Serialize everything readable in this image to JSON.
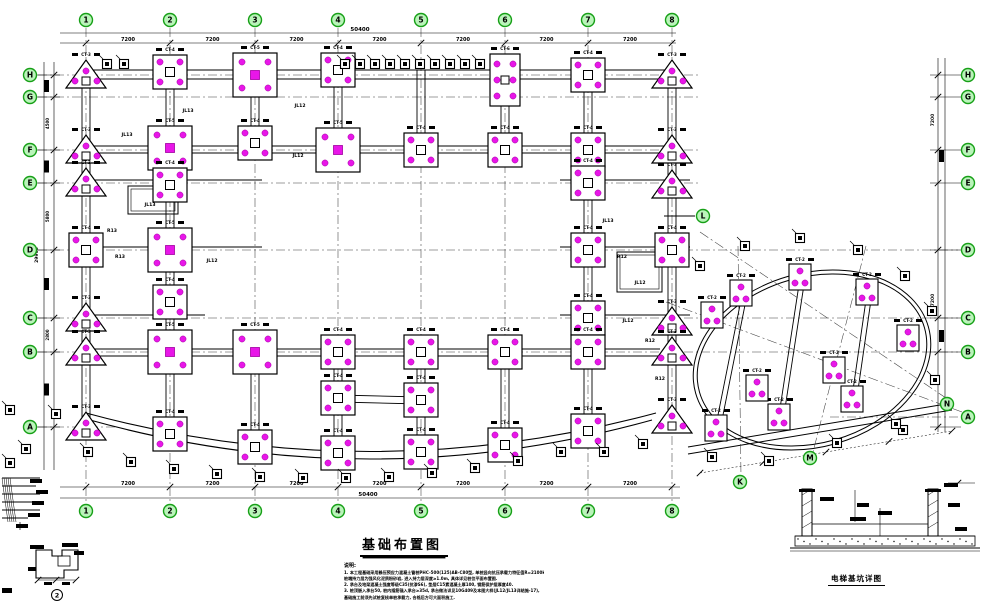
{
  "title_block": {
    "title": "基础布置图",
    "notes_heading": "说明:",
    "notes": [
      "1. 本工程基础采用静压预应力混凝土管桩PHC-500(125)AB-C80型, 单桩竖向抗压承载力特征值R=2100kN,",
      "   桩端持力层为强风化泥质粉砂岩, 进入持力层深度≥1.0m, 具体详见桩位平面布置图.",
      "2. 承台及地梁混凝土强度等级C35(抗渗S6), 垫层C15素混凝土厚100, 钢筋保护层厚度40.",
      "3. 桩顶嵌入承台50, 桩内插筋锚入承台≥35d, 承台做法详见10G409及本图大样(JL12/JL13详结施-17),",
      "   基础施工前须先试桩复核单桩承载力, 合格后方可大面积施工."
    ],
    "section_caption": "电梯基坑详图",
    "detail_bubble": "2"
  },
  "colors": {
    "pile": "#e816e8",
    "pile_edge": "#a000a0",
    "bubble_fill": "#baf4ba",
    "bubble_stroke": "#17a017",
    "bubble_text": "#0a5a0a",
    "line": "#000000",
    "grid": "#3c3c3c"
  },
  "axes": {
    "cols": [
      {
        "l": "1",
        "x": 86
      },
      {
        "l": "2",
        "x": 170
      },
      {
        "l": "3",
        "x": 255
      },
      {
        "l": "4",
        "x": 338
      },
      {
        "l": "5",
        "x": 421
      },
      {
        "l": "6",
        "x": 505
      },
      {
        "l": "7",
        "x": 588
      },
      {
        "l": "8",
        "x": 672
      }
    ],
    "rows": [
      {
        "l": "H",
        "y": 75,
        "x2": 700
      },
      {
        "l": "G",
        "y": 97,
        "x2": 700
      },
      {
        "l": "F",
        "y": 150,
        "x2": 700
      },
      {
        "l": "E",
        "y": 183,
        "x2": 700
      },
      {
        "l": "D",
        "y": 250,
        "x2": 958
      },
      {
        "l": "C",
        "y": 318,
        "x2": 958
      },
      {
        "l": "B",
        "y": 352,
        "x2": 958
      },
      {
        "l": "A",
        "y": 427,
        "x2": 118
      }
    ],
    "right_row_A_y": 417,
    "aux_bubbles": [
      {
        "l": "L",
        "x": 703,
        "y": 216
      },
      {
        "l": "K",
        "x": 740,
        "y": 482
      },
      {
        "l": "M",
        "x": 810,
        "y": 458
      },
      {
        "l": "N",
        "x": 947,
        "y": 404
      }
    ],
    "dims": {
      "seg": "7200",
      "top_total": "50400",
      "left_segs": [
        "1800",
        "4500",
        "2800",
        "5800",
        "5700",
        "2800",
        "6500"
      ],
      "left_total": "29900"
    }
  },
  "cap_tags": {
    "tri3": "CT-3",
    "sq4": "CT-4",
    "sq5": "CT-5",
    "sq6": "CT-6",
    "sq2w": "CT-2"
  },
  "caps": [
    [
      "tri3",
      86,
      75
    ],
    [
      "tri3",
      86,
      150
    ],
    [
      "tri3",
      86,
      183
    ],
    [
      "sq4",
      86,
      250
    ],
    [
      "tri3",
      86,
      318
    ],
    [
      "tri3",
      86,
      352
    ],
    [
      "tri3",
      86,
      427
    ],
    [
      "sq4",
      170,
      72
    ],
    [
      "sq5",
      170,
      148
    ],
    [
      "sq4",
      170,
      185
    ],
    [
      "sq5",
      170,
      250
    ],
    [
      "sq4",
      170,
      302
    ],
    [
      "sq5",
      170,
      352
    ],
    [
      "sq4",
      170,
      434
    ],
    [
      "sq5",
      255,
      75
    ],
    [
      "sq4",
      255,
      143
    ],
    [
      "sq5",
      255,
      352
    ],
    [
      "sq4",
      255,
      447
    ],
    [
      "sq4",
      338,
      70
    ],
    [
      "sq5",
      338,
      150
    ],
    [
      "sq4",
      338,
      352
    ],
    [
      "sq4",
      338,
      398
    ],
    [
      "sq4",
      338,
      453
    ],
    [
      "sq4",
      421,
      150
    ],
    [
      "sq4",
      421,
      352
    ],
    [
      "sq4",
      421,
      400
    ],
    [
      "sq4",
      421,
      452
    ],
    [
      "sq6",
      505,
      80
    ],
    [
      "sq4",
      505,
      150
    ],
    [
      "sq4",
      505,
      352
    ],
    [
      "sq4",
      505,
      445
    ],
    [
      "sq4",
      588,
      75
    ],
    [
      "sq4",
      588,
      150
    ],
    [
      "sq4",
      588,
      183
    ],
    [
      "sq4",
      588,
      250
    ],
    [
      "sq4",
      588,
      318
    ],
    [
      "sq4",
      588,
      352
    ],
    [
      "sq4",
      588,
      431
    ],
    [
      "tri3",
      672,
      75
    ],
    [
      "tri3",
      672,
      150
    ],
    [
      "tri3",
      672,
      185
    ],
    [
      "sq4",
      672,
      250
    ],
    [
      "tri3",
      672,
      322
    ],
    [
      "tri3",
      672,
      352
    ],
    [
      "tri3",
      672,
      420
    ],
    [
      "sq2w",
      712,
      315
    ],
    [
      "sq2w",
      741,
      293
    ],
    [
      "sq2w",
      800,
      277
    ],
    [
      "sq2w",
      867,
      292
    ],
    [
      "sq2w",
      908,
      338
    ],
    [
      "sq2w",
      716,
      428
    ],
    [
      "sq2w",
      779,
      417
    ],
    [
      "sq2w",
      852,
      399
    ],
    [
      "sq2w",
      757,
      388
    ],
    [
      "sq2w",
      834,
      370
    ]
  ],
  "pads": [
    [
      107,
      64
    ],
    [
      124,
      64
    ],
    [
      345,
      64
    ],
    [
      360,
      64
    ],
    [
      375,
      64
    ],
    [
      390,
      64
    ],
    [
      405,
      64
    ],
    [
      420,
      64
    ],
    [
      435,
      64
    ],
    [
      450,
      64
    ],
    [
      465,
      64
    ],
    [
      480,
      64
    ],
    [
      88,
      452
    ],
    [
      131,
      462
    ],
    [
      174,
      469
    ],
    [
      217,
      474
    ],
    [
      260,
      477
    ],
    [
      303,
      478
    ],
    [
      346,
      478
    ],
    [
      389,
      477
    ],
    [
      432,
      473
    ],
    [
      475,
      468
    ],
    [
      518,
      461
    ],
    [
      561,
      452
    ],
    [
      604,
      452
    ],
    [
      643,
      444
    ],
    [
      10,
      410
    ],
    [
      56,
      414
    ],
    [
      26,
      449
    ],
    [
      10,
      463
    ],
    [
      700,
      266
    ],
    [
      745,
      246
    ],
    [
      800,
      238
    ],
    [
      858,
      250
    ],
    [
      905,
      276
    ],
    [
      932,
      311
    ],
    [
      935,
      380
    ],
    [
      903,
      430
    ],
    [
      712,
      457
    ],
    [
      769,
      461
    ],
    [
      837,
      443
    ],
    [
      896,
      424
    ]
  ],
  "beam_labels": [
    {
      "t": "JL13",
      "x": 127,
      "y": 136
    },
    {
      "t": "R13",
      "x": 112,
      "y": 232
    },
    {
      "t": "JL13",
      "x": 188,
      "y": 112
    },
    {
      "t": "JL12",
      "x": 298,
      "y": 157
    },
    {
      "t": "JL13",
      "x": 150,
      "y": 206
    },
    {
      "t": "JL12",
      "x": 212,
      "y": 262
    },
    {
      "t": "R13",
      "x": 120,
      "y": 258
    },
    {
      "t": "JL13",
      "x": 608,
      "y": 222
    },
    {
      "t": "R12",
      "x": 622,
      "y": 258
    },
    {
      "t": "JL12",
      "x": 640,
      "y": 284
    },
    {
      "t": "JL12",
      "x": 628,
      "y": 322
    },
    {
      "t": "R12",
      "x": 650,
      "y": 342
    },
    {
      "t": "R12",
      "x": 660,
      "y": 380
    },
    {
      "t": "JL12",
      "x": 300,
      "y": 107
    }
  ],
  "geometry": {
    "beams": [
      [
        80,
        70,
        680,
        70
      ],
      [
        80,
        79,
        680,
        79
      ],
      [
        82,
        68,
        82,
        418
      ],
      [
        90,
        68,
        90,
        418
      ],
      [
        668,
        68,
        668,
        410
      ],
      [
        676,
        68,
        676,
        410
      ],
      [
        80,
        146,
        680,
        146
      ],
      [
        80,
        153,
        680,
        153
      ],
      [
        80,
        349,
        660,
        349
      ],
      [
        80,
        356,
        660,
        356
      ],
      [
        80,
        180,
        262,
        180
      ],
      [
        560,
        180,
        690,
        180
      ],
      [
        80,
        247,
        262,
        247
      ],
      [
        560,
        247,
        690,
        247
      ],
      [
        80,
        315,
        205,
        315
      ],
      [
        560,
        315,
        690,
        315
      ],
      [
        166,
        70,
        166,
        445
      ],
      [
        174,
        70,
        174,
        445
      ],
      [
        584,
        70,
        584,
        440
      ],
      [
        592,
        70,
        592,
        440
      ],
      [
        251,
        70,
        251,
        160
      ],
      [
        259,
        70,
        259,
        160
      ],
      [
        251,
        340,
        251,
        455
      ],
      [
        259,
        340,
        259,
        455
      ],
      [
        334,
        70,
        334,
        160
      ],
      [
        342,
        70,
        342,
        160
      ],
      [
        334,
        340,
        334,
        460
      ],
      [
        342,
        340,
        342,
        460
      ],
      [
        417,
        70,
        417,
        160
      ],
      [
        425,
        70,
        425,
        160
      ],
      [
        417,
        340,
        417,
        460
      ],
      [
        425,
        340,
        425,
        460
      ],
      [
        501,
        70,
        501,
        160
      ],
      [
        509,
        70,
        509,
        160
      ],
      [
        501,
        340,
        501,
        452
      ],
      [
        509,
        340,
        509,
        452
      ],
      [
        338,
        395,
        421,
        397
      ],
      [
        338,
        402,
        421,
        404
      ],
      [
        664,
        216,
        695,
        216
      ]
    ],
    "arcs": [
      "M86,413 Q370,490 656,413",
      "M90,420 Q370,498 652,420"
    ],
    "pits": [
      [
        617,
        252,
        45,
        40
      ],
      [
        128,
        186,
        50,
        28
      ]
    ],
    "wing": {
      "cx": 812,
      "cy": 360,
      "rx": 121,
      "ry": 87,
      "rot": -16,
      "chords": [
        [
          742,
          295,
          716,
          425
        ],
        [
          800,
          278,
          779,
          415
        ],
        [
          867,
          293,
          852,
          397
        ]
      ],
      "band": [
        [
          688,
          447,
          952,
          403
        ],
        [
          688,
          454,
          952,
          410
        ]
      ],
      "axis_lines": [
        [
          700,
          232,
          946,
          398
        ],
        [
          666,
          302,
          962,
          412
        ],
        [
          738,
          246,
          741,
          476
        ],
        [
          866,
          246,
          813,
          452
        ]
      ],
      "dim_line": [
        700,
        473,
        952,
        431
      ]
    }
  }
}
